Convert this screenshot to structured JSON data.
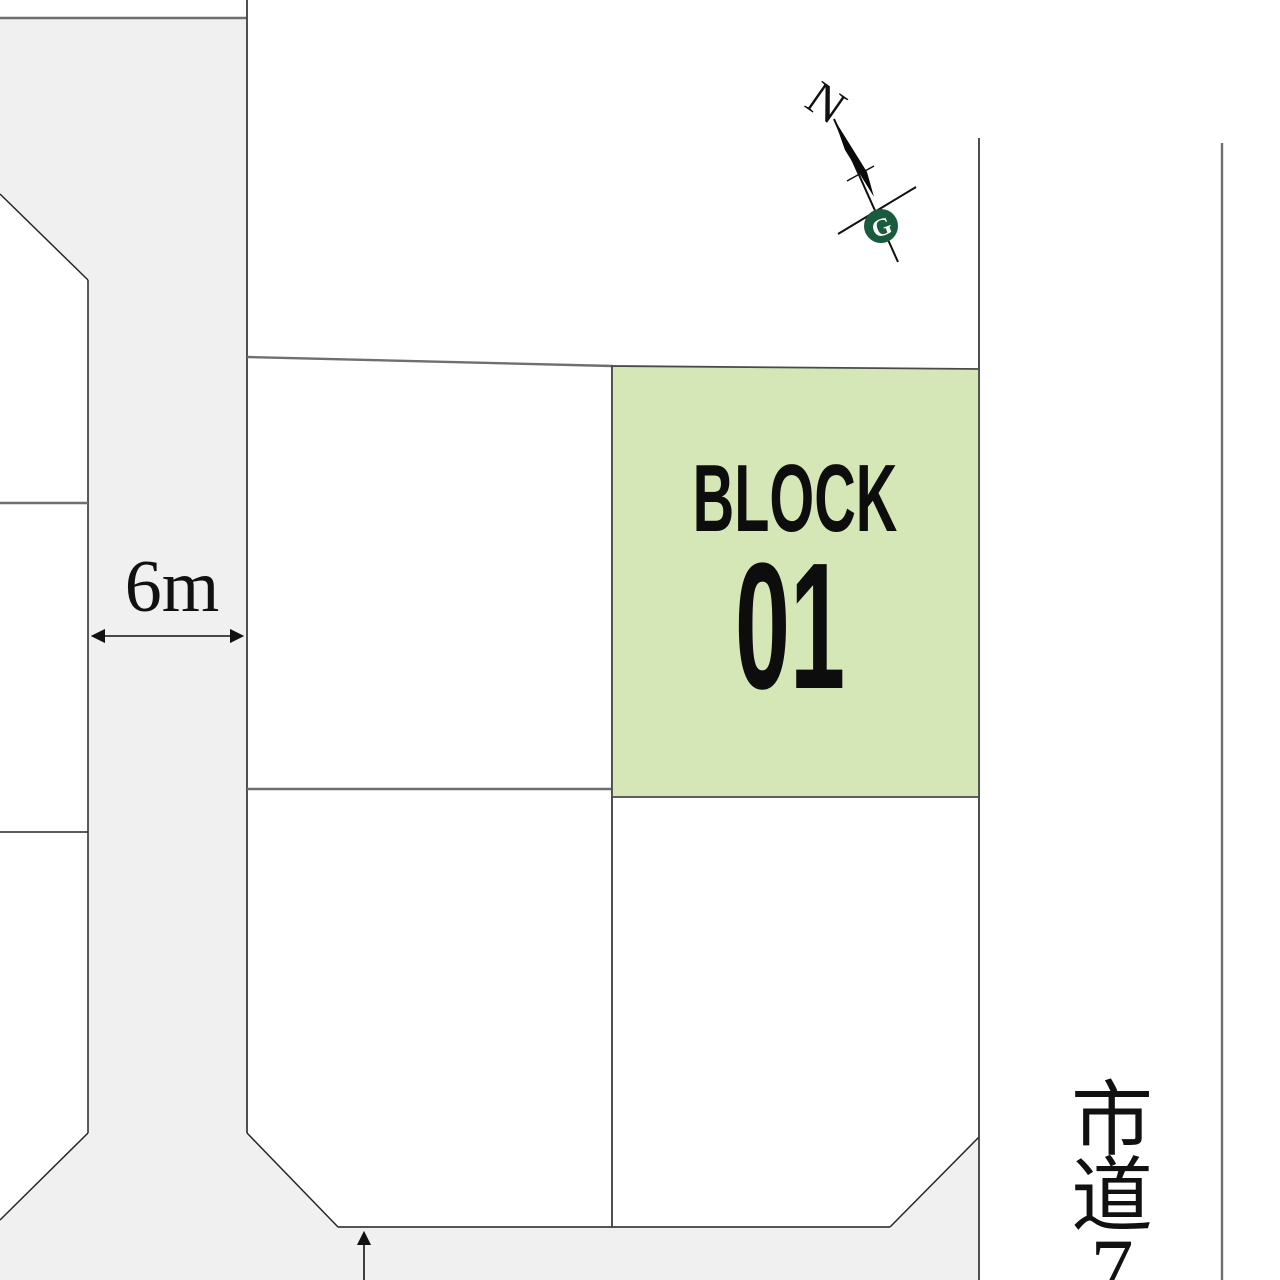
{
  "colors": {
    "background": "#ffffff",
    "road_fill": "#f0f0f0",
    "highlight_fill": "#d5e7b7",
    "compass_green": "#1a5a3d"
  },
  "highlight_lot": {
    "label": "BLOCK",
    "number": "01"
  },
  "annotations": {
    "road_width": "6m"
  },
  "right_road": {
    "name": "市道7",
    "chars": [
      "市",
      "道",
      "7"
    ]
  },
  "compass": {
    "north_label": "N",
    "logo_glyph": "G"
  }
}
